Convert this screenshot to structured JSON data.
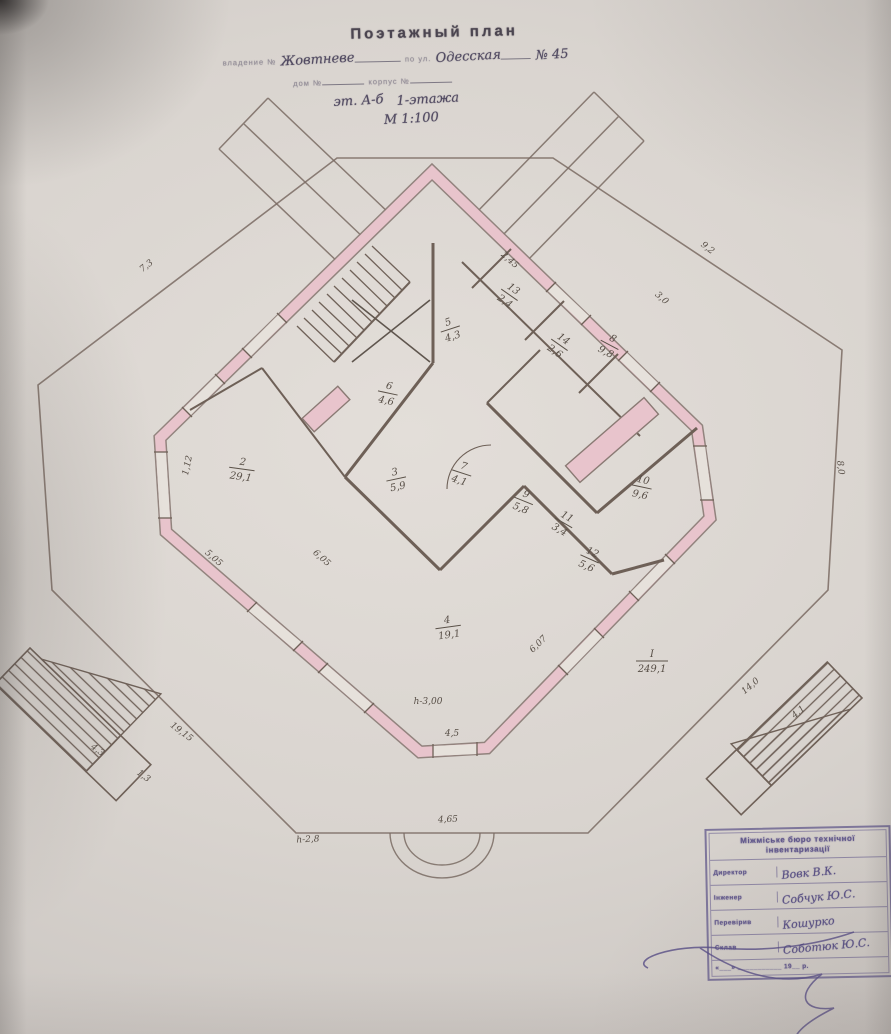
{
  "document": {
    "title": "Поэтажный план",
    "line1_label": "владение №",
    "line1_value": "Жовтневе",
    "line1_label2": "по ул.",
    "line1_value2": "Одесская",
    "line1_number": "№ 45",
    "line2_label1": "дом №",
    "line2_label2": "корпус №",
    "line3_value1": "эт. А-б",
    "line3_value2": "1-этажа",
    "scale": "М 1:100"
  },
  "plan": {
    "colors": {
      "wall_pink": "#e8c4cc",
      "line": "#7a6b63",
      "ink": "#564d7e"
    },
    "rooms": [
      {
        "num": "5",
        "area": "4,3",
        "x": 450,
        "y": 328,
        "rot": -18
      },
      {
        "num": "6",
        "area": "4,6",
        "x": 388,
        "y": 392,
        "rot": 12
      },
      {
        "num": "2",
        "area": "29,1",
        "x": 242,
        "y": 468,
        "rot": 8
      },
      {
        "num": "3",
        "area": "5,9",
        "x": 396,
        "y": 478,
        "rot": -12
      },
      {
        "num": "7",
        "area": "4,1",
        "x": 462,
        "y": 472,
        "rot": 18
      },
      {
        "num": "13",
        "area": "2,4",
        "x": 510,
        "y": 294,
        "rot": 35
      },
      {
        "num": "14",
        "area": "2,6",
        "x": 560,
        "y": 344,
        "rot": 35
      },
      {
        "num": "8",
        "area": "9,8",
        "x": 610,
        "y": 344,
        "rot": 28
      },
      {
        "num": "9",
        "area": "5,8",
        "x": 524,
        "y": 500,
        "rot": 22
      },
      {
        "num": "10",
        "area": "9,6",
        "x": 642,
        "y": 486,
        "rot": 12
      },
      {
        "num": "11",
        "area": "3,4",
        "x": 564,
        "y": 522,
        "rot": 30
      },
      {
        "num": "12",
        "area": "5,6",
        "x": 590,
        "y": 558,
        "rot": 24
      },
      {
        "num": "4",
        "area": "19,1",
        "x": 448,
        "y": 626,
        "rot": -8
      },
      {
        "num": "I",
        "area": "249,1",
        "x": 652,
        "y": 660,
        "rot": 0
      }
    ],
    "dimensions": [
      {
        "text": "7,3",
        "x": 148,
        "y": 268,
        "rot": -38
      },
      {
        "text": "9,2",
        "x": 706,
        "y": 250,
        "rot": 38
      },
      {
        "text": "8,0",
        "x": 838,
        "y": 468,
        "rot": 83
      },
      {
        "text": "4,5",
        "x": 452,
        "y": 736,
        "rot": 0
      },
      {
        "text": "1,12",
        "x": 190,
        "y": 466,
        "rot": -78
      },
      {
        "text": "5,05",
        "x": 212,
        "y": 560,
        "rot": 41
      },
      {
        "text": "19,15",
        "x": 180,
        "y": 734,
        "rot": 37
      },
      {
        "text": "4,3",
        "x": 96,
        "y": 752,
        "rot": 37
      },
      {
        "text": "1,3",
        "x": 142,
        "y": 778,
        "rot": 37
      },
      {
        "text": "14,0",
        "x": 752,
        "y": 688,
        "rot": -40
      },
      {
        "text": "4,1",
        "x": 800,
        "y": 714,
        "rot": -40
      },
      {
        "text": "4,65",
        "x": 448,
        "y": 822,
        "rot": -2
      },
      {
        "text": "h-2,8",
        "x": 308,
        "y": 842,
        "rot": -3
      },
      {
        "text": "h-3,00",
        "x": 428,
        "y": 704,
        "rot": 0
      },
      {
        "text": "6,05",
        "x": 320,
        "y": 560,
        "rot": 42
      },
      {
        "text": "6,07",
        "x": 540,
        "y": 646,
        "rot": -44
      },
      {
        "text": "2,45",
        "x": 508,
        "y": 262,
        "rot": 42
      },
      {
        "text": "3,0",
        "x": 660,
        "y": 300,
        "rot": 42
      }
    ]
  },
  "stamp": {
    "header_line1": "Міжміське бюро технічної",
    "header_line2": "інвентаризації",
    "rows": [
      {
        "label": "Директор",
        "value": "Вовк В.К."
      },
      {
        "label": "Інженер",
        "value": "Собчук Ю.С."
      },
      {
        "label": "Перевірив",
        "value": "Кошурко"
      },
      {
        "label": "Склав",
        "value": "Соботюк Ю.С."
      }
    ],
    "date_line": "«___» ___________ 19__ р."
  }
}
